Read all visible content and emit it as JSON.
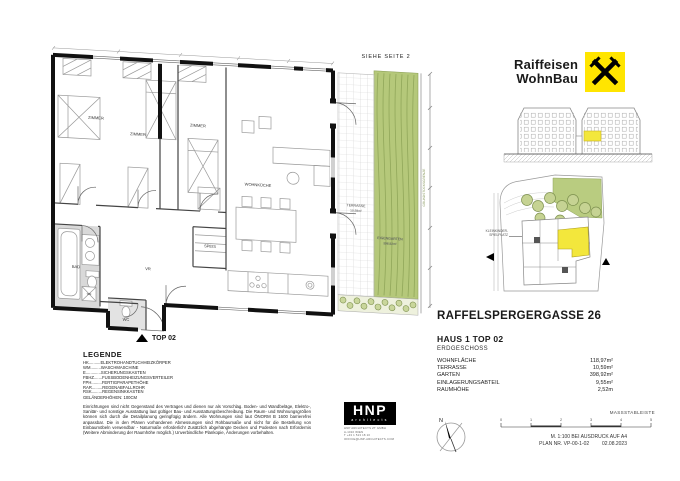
{
  "header": {
    "brand_line1": "Raiffeisen",
    "brand_line2": "WohnBau"
  },
  "plan": {
    "see_page": "SIEHE SEITE 2",
    "entry_marker": "TOP 02",
    "rooms": {
      "zimmer1": "ZIMMER",
      "zimmer2": "ZIMMER",
      "zimmer3": "ZIMMER",
      "wohnkueche": "WOHNKÜCHE",
      "bad": "BAD",
      "wc": "WC",
      "vr": "VR",
      "speis": "SPEIS",
      "terrasse": "TERRASSE",
      "garten": "EIGENGARTEN"
    },
    "terrasse_area": "10,59m²",
    "garten_area": "398,92m²",
    "wm_label": "WM",
    "boundary_label": "GRUNDSTÜCKSGRENZE"
  },
  "site": {
    "playground_line1": "KLEINKINDER-",
    "playground_line2": "SPIELPLATZ"
  },
  "project": {
    "street": "RAFFELSPERGERGASSE 26",
    "unit": "HAUS 1 TOP 02",
    "floor": "ERDGESCHOSS",
    "stats": [
      {
        "label": "WOHNFLÄCHE",
        "value": "118,97m²"
      },
      {
        "label": "TERRASSE",
        "value": "10,59m²"
      },
      {
        "label": "GARTEN",
        "value": "398,92m²"
      },
      {
        "label": "EINLAGERUNGSABTEIL",
        "value": "9,55m²"
      },
      {
        "label": "RAUMHÖHE",
        "value": "2,52m"
      }
    ]
  },
  "legend": {
    "title": "LEGENDE",
    "items": [
      "HK..........ELEKTROHANDTUCHHEIZKÖRPER",
      "WM.........WASCHMASCHINE",
      "E.............SICHERUNGSKASTEN",
      "FBHZ.......FUSSBODENHEIZUNGSVERTEILER",
      "FPH.........FERTIGPARAPETHÖHE",
      "RAR.........REGENABFALLROHR",
      "RSK.........REGENSINKKASTEN"
    ],
    "railing": "GELÄNDERHÖHEN: 100CM"
  },
  "disclaimer": "Einrichtungen sind nicht Gegenstand des Vertrages und dienen nur als Vorschlag. Boden- und Wandbeläge, Elektro-, Sanitär- und sonstige Ausstattung laut gültiger Bau- und Ausstattungsbeschreibung. Die Raum- und Wohnungsgrößen können sich durch die Detailplanung geringfügig ändern. Alle Wohnungen sind laut ÖNORM B 1600 barrierefrei anpassbar. Die in den Plänen vorhandenen Abmessungen sind Rohbaumaße und nicht für die Bestellung von Einbaumöbeln verwendbar - Naturmaße erforderlich! Zusätzlich abgehängte Decken und Podesten nach Erfordernis (Weitere Abminderung der Raumhöhe möglich.) Unverbindliche Plankopie, Änderungen vorbehalten.",
  "scale": {
    "title": "MASSSTABLEISTE",
    "ticks": [
      "0",
      "1",
      "2",
      "3",
      "4",
      "5"
    ],
    "print_line": "M. 1:100 BEI AUSDRUCK AUF A4",
    "plan_nr": "PLAN NR. VP-00-1-02",
    "date": "02.08.2023",
    "north": "N"
  },
  "architect": {
    "logo_top": "HNP",
    "logo_bottom": "architects",
    "info_lines": [
      "HNP ARCHITECTS ZT GMBH",
      "A-1010 WIEN",
      "T +43 1 513 18 10",
      "OFFICE@HNP-ARCHITECTS.COM"
    ]
  },
  "colors": {
    "brand_yellow": "#ffe500",
    "unit_yellow": "#f3e73c",
    "garden_green": "#b5c87a",
    "bath_gray": "#d9d9d9",
    "wall_black": "#111111"
  }
}
